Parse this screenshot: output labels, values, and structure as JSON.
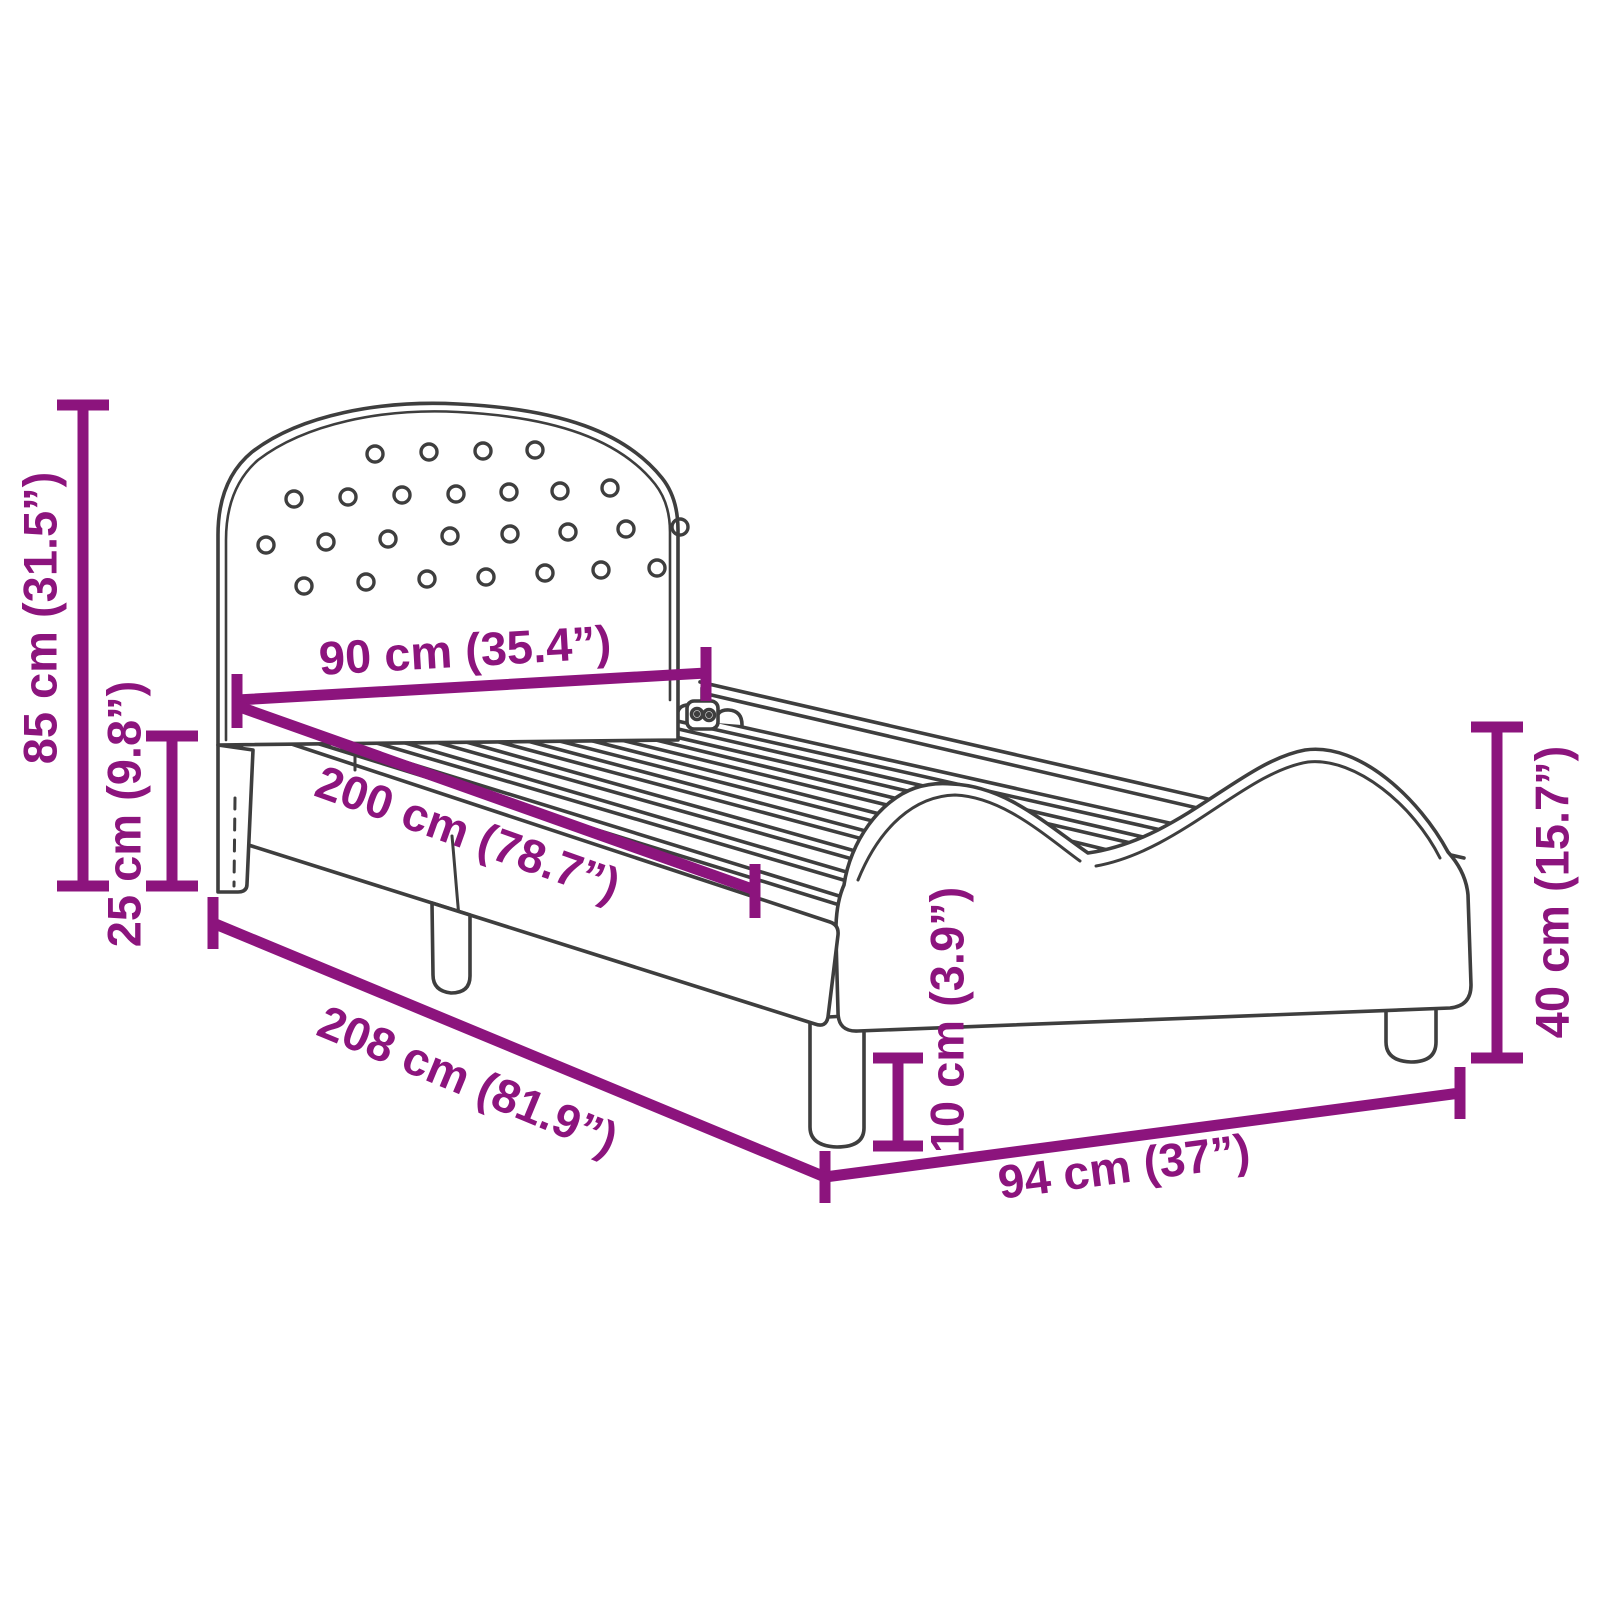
{
  "diagram": {
    "type": "product-dimension-diagram",
    "subject": "kids-bed-frame-with-slats",
    "accent_color": "#8C147D",
    "outline_color": "#3E3E3E",
    "background": "#FFFFFF",
    "dimensions": {
      "headboard_height": {
        "label": "85 cm (31.5”)"
      },
      "rail_height": {
        "label": "25 cm (9.8”)"
      },
      "headboard_width": {
        "label": "90 cm (35.4”)"
      },
      "inner_length": {
        "label": "200 cm (78.7”)"
      },
      "total_length": {
        "label": "208 cm (81.9”)"
      },
      "total_width": {
        "label": "94 cm (37”)"
      },
      "leg_height": {
        "label": "10 cm (3.9”)"
      },
      "footboard_height": {
        "label": "40 cm (15.7”)"
      }
    }
  }
}
